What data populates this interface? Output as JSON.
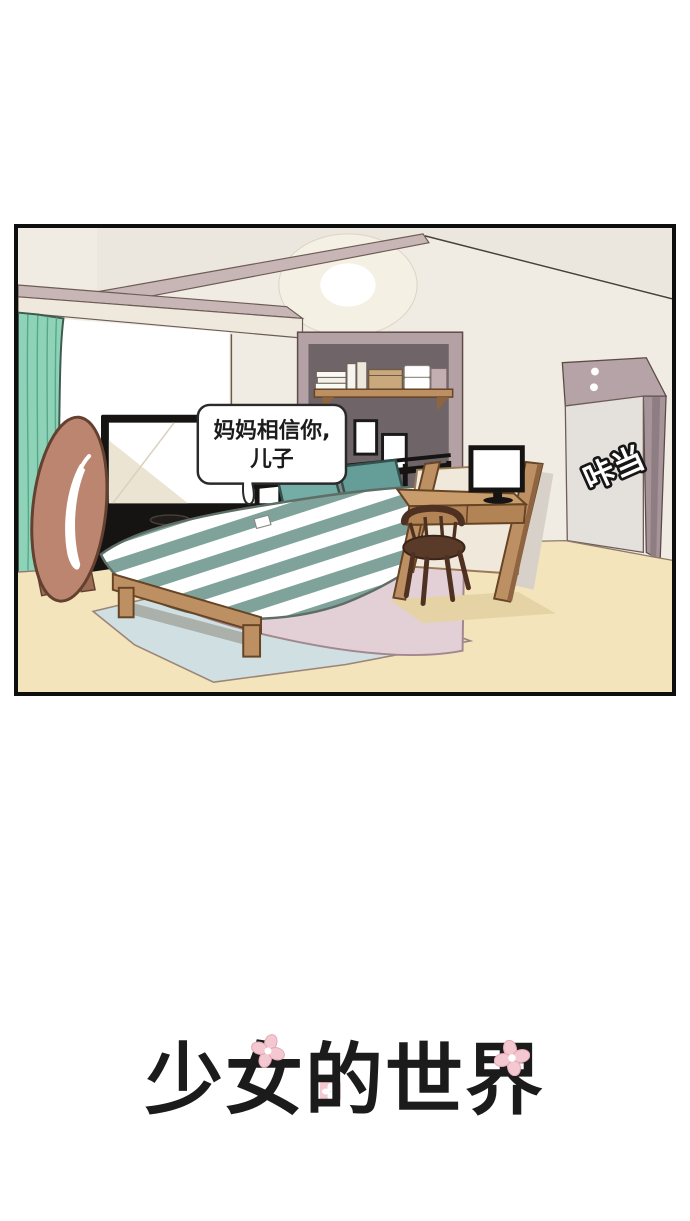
{
  "comic": {
    "speech_bubble": {
      "line1": "妈妈相信你,",
      "line2": "儿子"
    },
    "sfx": "咔当"
  },
  "title": {
    "text": "少女的世界"
  },
  "palette": {
    "paper": "#ffffff",
    "ink": "#161413",
    "wall": "#f1ece3",
    "ceiling": "#ece7de",
    "beam": "#c8b6b6",
    "beamEdge": "#6d5c55",
    "lampGlow": "#f5f0e4",
    "curtain": "#8ed2b7",
    "curtainFold": "#56a78c",
    "curtainOutline": "#3f5a4e",
    "windowWhite": "#ffffff",
    "accentFrame": "#b3a1a6",
    "accentWall": "#6f6468",
    "wood": "#bd9064",
    "woodDark": "#8f6440",
    "woodOutline": "#664424",
    "shelfBoxTan": "#c8a87c",
    "screenTint": "#ece4d2",
    "mirror": "#bb8570",
    "mirrorOutline": "#63402f",
    "pillowTeal": "#74aca6",
    "pillowTeal2": "#659e99",
    "pillowOutline": "#32524d",
    "stripe": "#7fa39a",
    "duvetOutline": "#5e6e67",
    "bedPink": "#e2d0d6",
    "bedPinkOutline": "#a3878e",
    "rug": "#cfdfe2",
    "rugOutline": "#9c8577",
    "floor": "#f3e4bc",
    "floorLine": "#8d7a6a",
    "floorShadow": "#e5d2a5",
    "chair": "#5a3a29",
    "chairOutline": "#3a2418",
    "nook": "#b5a3a8",
    "nookMid": "#a6949a",
    "nookDark": "#8f7d84",
    "door": "#e4e0dc",
    "shadowWall": "#d8d1ca",
    "grayBox": "#8b8b8b",
    "bubbleBorder": "#2a2a2a",
    "titleInk": "#1b1b1b",
    "flowerPink": "#f4c8d1",
    "flowerEdge": "#e3a8b6"
  }
}
